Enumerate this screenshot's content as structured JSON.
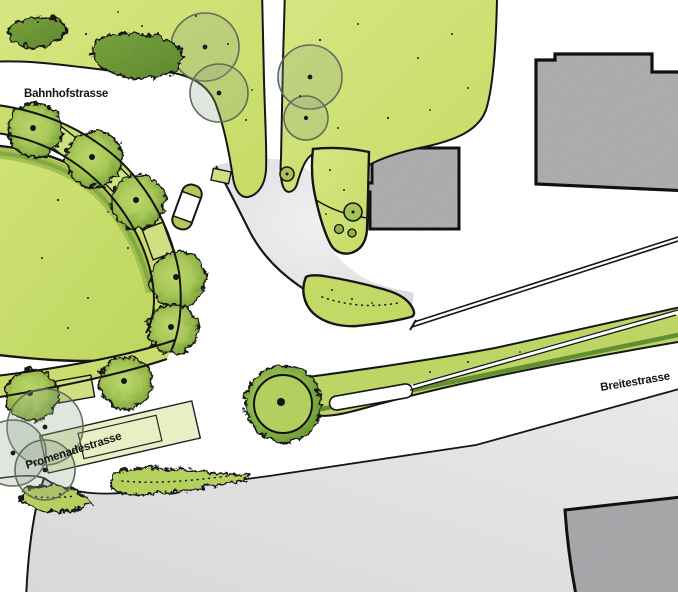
{
  "map": {
    "type": "landscape-site-plan",
    "labels": {
      "bahnhofstrasse": "Bahnhofstrasse",
      "promenadestrasse": "Promenadestrasse",
      "breitestrasse": "Breitestrasse"
    },
    "palette": {
      "lawn": "#cde06e",
      "lawn_dark_band": "#9cbd4e",
      "tree_canopy": "#a4c455",
      "tree_rim": "#6e9635",
      "hedge": "#5d8a2f",
      "building_gray": "#b2b2b5",
      "plaza_gray": "#e4e4e7",
      "bottom_block_gray": "#dededf",
      "outline": "#161616",
      "existing_tree_outline": "#5f6e5c",
      "background": "#ffffff"
    }
  }
}
